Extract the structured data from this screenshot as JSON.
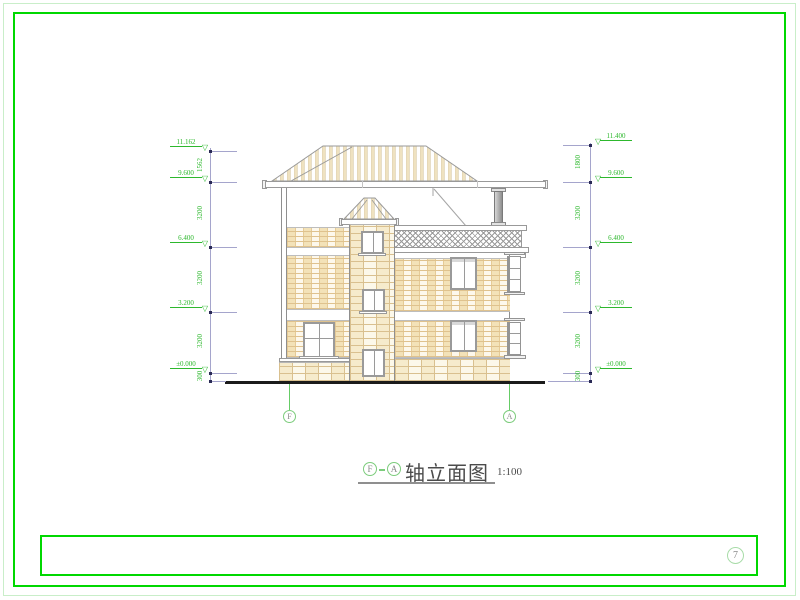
{
  "sheet": {
    "page_number": "7"
  },
  "title_bar": {
    "axis_start": "F",
    "axis_end": "A",
    "name": "轴立面图",
    "scale": "1:100"
  },
  "axis_bubbles": {
    "left": "F",
    "right": "A"
  },
  "dimensions": {
    "left": {
      "elevations": [
        "11.162",
        "9.600",
        "6.400",
        "3.200",
        "±0.000"
      ],
      "segments": [
        "1562",
        "3200",
        "3200",
        "3200",
        "300"
      ]
    },
    "right": {
      "elevations": [
        "11.400",
        "9.600",
        "6.400",
        "3.200",
        "±0.000"
      ],
      "segments": [
        "1800",
        "3200",
        "3200",
        "3200",
        "300"
      ]
    }
  },
  "colors": {
    "frame_green": "#00d800",
    "annotation_green": "#2db82d",
    "drawing_gray": "#999999",
    "brick_tan": "#dfc28e",
    "ground": "#1b1b1b"
  }
}
